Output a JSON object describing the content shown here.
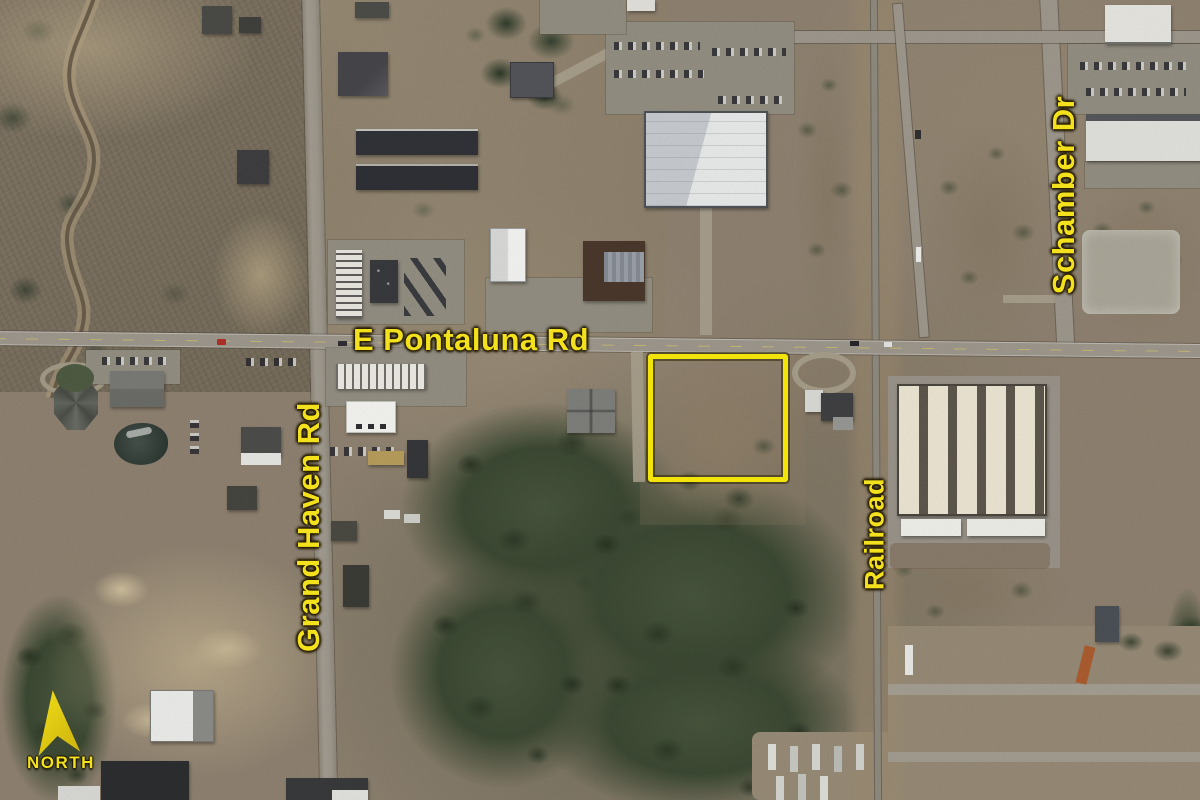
{
  "map": {
    "labels": {
      "pontaluna": "E Pontaluna Rd",
      "grand_haven": "Grand Haven Rd",
      "railroad": "Railroad",
      "schamber": "Schamber Dr"
    },
    "north_arrow": {
      "label": "NORTH"
    },
    "colors": {
      "annotation_yellow": "#f2e11c",
      "parcel_outline_yellow": "#f2e40a"
    }
  }
}
